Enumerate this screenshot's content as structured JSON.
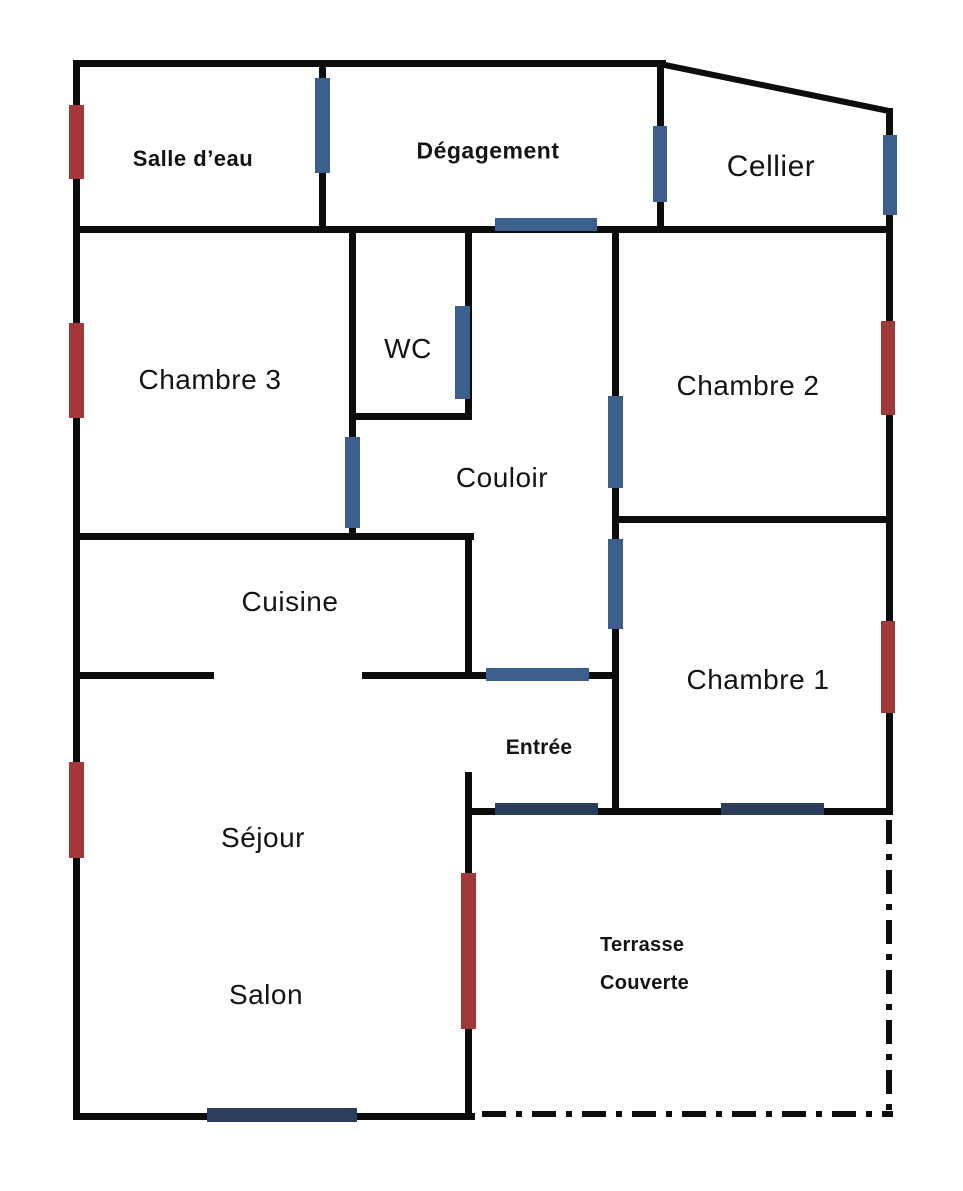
{
  "title": "Plan d'appartement",
  "colors": {
    "wall": "#0d0d0d",
    "door_blue": "#3c5f8e",
    "marker_navy": "#2b3d5c",
    "window_red": "#a03a3a",
    "background": "#ffffff"
  },
  "rooms": {
    "salle_deau": {
      "label": "Salle d’eau"
    },
    "degagement": {
      "label": "Dégagement"
    },
    "cellier": {
      "label": "Cellier"
    },
    "chambre3": {
      "label": "Chambre 3"
    },
    "wc": {
      "label": "WC"
    },
    "couloir": {
      "label": "Couloir"
    },
    "chambre2": {
      "label": "Chambre 2"
    },
    "cuisine": {
      "label": "Cuisine"
    },
    "entree": {
      "label": "Entrée"
    },
    "chambre1": {
      "label": "Chambre 1"
    },
    "sejour": {
      "label": "Séjour"
    },
    "salon": {
      "label": "Salon"
    },
    "terrasse": {
      "line1": "Terrasse",
      "line2": "Couverte"
    }
  },
  "plan": {
    "walls": [
      {
        "name": "outer-top-wall",
        "x": 73,
        "y": 60,
        "w": 593,
        "h": 7
      },
      {
        "name": "outer-left-wall",
        "x": 73,
        "y": 60,
        "w": 7,
        "h": 1060
      },
      {
        "name": "outer-right-wall",
        "x": 886,
        "y": 108,
        "w": 7,
        "h": 707
      },
      {
        "name": "outer-bottom-wall",
        "x": 73,
        "y": 1113,
        "w": 402,
        "h": 7
      },
      {
        "name": "upper-band-bottom-wall",
        "x": 73,
        "y": 226,
        "w": 820,
        "h": 7
      },
      {
        "name": "wc-bottom-wall",
        "x": 349,
        "y": 413,
        "w": 122,
        "h": 7
      },
      {
        "name": "chambre3-bottom-wall",
        "x": 73,
        "y": 533,
        "w": 401,
        "h": 7
      },
      {
        "name": "chambre2-bottom-wall",
        "x": 612,
        "y": 516,
        "w": 281,
        "h": 7
      },
      {
        "name": "cuisine-bottom-wall-left",
        "x": 73,
        "y": 672,
        "w": 141,
        "h": 7
      },
      {
        "name": "cuisine-entree-top-wall",
        "x": 362,
        "y": 672,
        "w": 256,
        "h": 7
      },
      {
        "name": "terrasse-top-wall",
        "x": 465,
        "y": 808,
        "w": 428,
        "h": 7
      },
      {
        "name": "salledeau-degagement-wall",
        "x": 319,
        "y": 60,
        "w": 7,
        "h": 173
      },
      {
        "name": "degagement-cellier-wall",
        "x": 657,
        "y": 60,
        "w": 7,
        "h": 173
      },
      {
        "name": "wc-left-chambre3-wall",
        "x": 349,
        "y": 226,
        "w": 7,
        "h": 314
      },
      {
        "name": "wc-right-wall",
        "x": 465,
        "y": 226,
        "w": 7,
        "h": 194
      },
      {
        "name": "couloir-right-wall",
        "x": 612,
        "y": 226,
        "w": 7,
        "h": 589
      },
      {
        "name": "cuisine-right-wall",
        "x": 465,
        "y": 533,
        "w": 7,
        "h": 146
      },
      {
        "name": "salon-terrasse-wall",
        "x": 465,
        "y": 772,
        "w": 7,
        "h": 348
      }
    ],
    "lines": [
      {
        "name": "roof-diagonal-wall",
        "x1": 660,
        "y1": 64,
        "x2": 889,
        "y2": 111,
        "width": 6,
        "dashed": false
      },
      {
        "name": "terrasse-dashdot-right",
        "x1": 889,
        "y1": 820,
        "x2": 889,
        "y2": 1114,
        "width": 6,
        "dashed": true
      },
      {
        "name": "terrasse-dashdot-bottom",
        "x1": 482,
        "y1": 1114,
        "x2": 893,
        "y2": 1114,
        "width": 6,
        "dashed": true
      }
    ],
    "openings": [
      {
        "name": "door-salledeau-degagement",
        "color": "door_blue",
        "x": 315,
        "y": 78,
        "w": 15,
        "h": 95
      },
      {
        "name": "door-degagement-cellier",
        "color": "door_blue",
        "x": 653,
        "y": 126,
        "w": 14,
        "h": 76
      },
      {
        "name": "window-cellier",
        "color": "door_blue",
        "x": 883,
        "y": 135,
        "w": 14,
        "h": 80
      },
      {
        "name": "door-degagement-couloir",
        "color": "door_blue",
        "x": 495,
        "y": 218,
        "w": 102,
        "h": 13
      },
      {
        "name": "door-wc",
        "color": "door_blue",
        "x": 455,
        "y": 306,
        "w": 15,
        "h": 93
      },
      {
        "name": "door-chambre3",
        "color": "door_blue",
        "x": 345,
        "y": 437,
        "w": 15,
        "h": 91
      },
      {
        "name": "door-chambre2",
        "color": "door_blue",
        "x": 608,
        "y": 396,
        "w": 15,
        "h": 92
      },
      {
        "name": "door-chambre1",
        "color": "door_blue",
        "x": 608,
        "y": 539,
        "w": 15,
        "h": 90
      },
      {
        "name": "door-couloir-entree",
        "color": "door_blue",
        "x": 486,
        "y": 668,
        "w": 103,
        "h": 13
      },
      {
        "name": "front-door-entree",
        "color": "marker_navy",
        "x": 495,
        "y": 803,
        "w": 103,
        "h": 12
      },
      {
        "name": "window-chambre1-terrasse",
        "color": "marker_navy",
        "x": 721,
        "y": 803,
        "w": 103,
        "h": 12
      },
      {
        "name": "window-salon",
        "color": "marker_navy",
        "x": 207,
        "y": 1108,
        "w": 150,
        "h": 14
      },
      {
        "name": "window-salle-deau",
        "color": "window_red",
        "x": 69,
        "y": 105,
        "w": 15,
        "h": 74
      },
      {
        "name": "window-chambre3",
        "color": "window_red",
        "x": 69,
        "y": 323,
        "w": 15,
        "h": 95
      },
      {
        "name": "window-sejour",
        "color": "window_red",
        "x": 69,
        "y": 762,
        "w": 15,
        "h": 96
      },
      {
        "name": "window-chambre2",
        "color": "window_red",
        "x": 881,
        "y": 321,
        "w": 14,
        "h": 94
      },
      {
        "name": "window-chambre1",
        "color": "window_red",
        "x": 881,
        "y": 621,
        "w": 14,
        "h": 92
      },
      {
        "name": "door-salon-terrasse",
        "color": "window_red",
        "x": 461,
        "y": 873,
        "w": 15,
        "h": 156
      }
    ]
  }
}
